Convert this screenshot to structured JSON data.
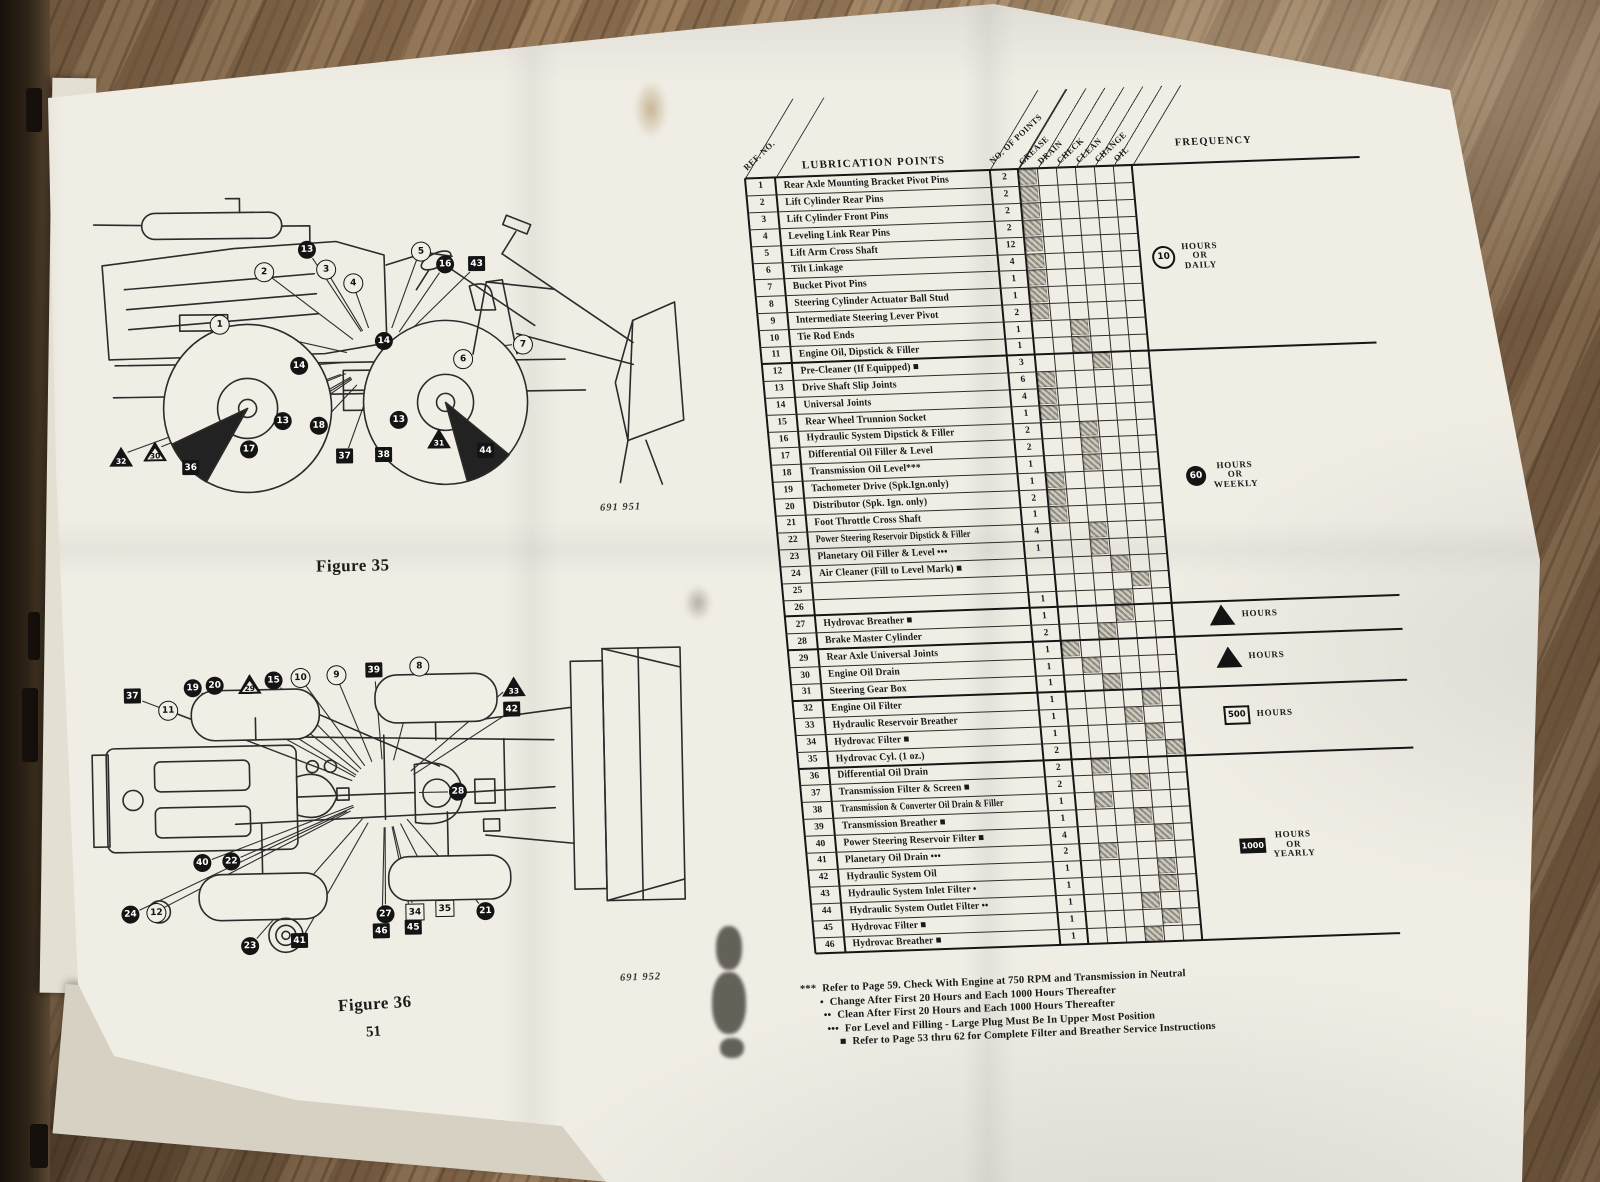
{
  "document": {
    "figure35": {
      "caption": "Figure 35",
      "photo_code": "691 951"
    },
    "figure36": {
      "caption": "Figure 36",
      "photo_code": "691 952"
    },
    "page_number": "51"
  },
  "table": {
    "title": "LUBRICATION POINTS",
    "ref_header": "REF. NO.",
    "points_header": "NO. OF POINTS",
    "frequency_header": "FREQUENCY",
    "operation_columns": [
      "GREASE",
      "DRAIN",
      "CHECK",
      "CLEAN",
      "CHANGE",
      "OIL"
    ],
    "rows": [
      {
        "ref": "1",
        "label": "Rear Axle Mounting Bracket Pivot Pins",
        "points": "2",
        "marks": [
          "grease"
        ]
      },
      {
        "ref": "2",
        "label": "Lift Cylinder Rear Pins",
        "points": "2",
        "marks": [
          "grease"
        ]
      },
      {
        "ref": "3",
        "label": "Lift Cylinder Front Pins",
        "points": "2",
        "marks": [
          "grease"
        ]
      },
      {
        "ref": "4",
        "label": "Leveling Link Rear Pins",
        "points": "2",
        "marks": [
          "grease"
        ]
      },
      {
        "ref": "5",
        "label": "Lift Arm Cross Shaft",
        "points": "12",
        "marks": [
          "grease"
        ]
      },
      {
        "ref": "6",
        "label": "Tilt Linkage",
        "points": "4",
        "marks": [
          "grease"
        ]
      },
      {
        "ref": "7",
        "label": "Bucket Pivot Pins",
        "points": "1",
        "marks": [
          "grease"
        ]
      },
      {
        "ref": "8",
        "label": "Steering Cylinder Actuator Ball Stud",
        "points": "1",
        "marks": [
          "grease"
        ]
      },
      {
        "ref": "9",
        "label": "Intermediate Steering Lever Pivot",
        "points": "2",
        "marks": [
          "grease"
        ]
      },
      {
        "ref": "10",
        "label": "Tie Rod Ends",
        "points": "1",
        "marks": [
          "check"
        ]
      },
      {
        "ref": "11",
        "label": "Engine Oil, Dipstick & Filler",
        "points": "1",
        "marks": [
          "check"
        ]
      },
      {
        "ref": "12",
        "label": "Pre-Cleaner (If Equipped) ■",
        "points": "3",
        "marks": [
          "clean"
        ]
      },
      {
        "ref": "13",
        "label": "Drive Shaft Slip Joints",
        "points": "6",
        "marks": [
          "grease"
        ]
      },
      {
        "ref": "14",
        "label": "Universal Joints",
        "points": "4",
        "marks": [
          "grease"
        ]
      },
      {
        "ref": "15",
        "label": "Rear Wheel Trunnion Socket",
        "points": "1",
        "marks": [
          "grease"
        ]
      },
      {
        "ref": "16",
        "label": "Hydraulic System Dipstick & Filler",
        "points": "2",
        "marks": [
          "check"
        ]
      },
      {
        "ref": "17",
        "label": "Differential Oil Filler & Level",
        "points": "2",
        "marks": [
          "check"
        ]
      },
      {
        "ref": "18",
        "label": "Transmission Oil Level***",
        "points": "1",
        "marks": [
          "check"
        ]
      },
      {
        "ref": "19",
        "label": "Tachometer Drive (Spk.Ign.only)",
        "points": "1",
        "marks": [
          "grease"
        ]
      },
      {
        "ref": "20",
        "label": "Distributor (Spk. Ign. only)",
        "points": "2",
        "marks": [
          "grease"
        ]
      },
      {
        "ref": "21",
        "label": "Foot Throttle Cross Shaft",
        "points": "1",
        "marks": [
          "grease"
        ]
      },
      {
        "ref": "22",
        "label": "Power Steering Reservoir Dipstick & Filler",
        "points": "4",
        "marks": [
          "check"
        ]
      },
      {
        "ref": "23",
        "label": "Planetary Oil Filler & Level •••",
        "points": "1",
        "marks": [
          "check"
        ]
      },
      {
        "ref": "24",
        "label": "Air Cleaner (Fill to Level Mark) ■",
        "points": "",
        "marks": [
          "clean"
        ]
      },
      {
        "ref": "25",
        "label": "",
        "points": "",
        "marks": [
          "change"
        ]
      },
      {
        "ref": "26",
        "label": "",
        "points": "1",
        "marks": [
          "clean"
        ]
      },
      {
        "ref": "27",
        "label": "Hydrovac Breather ■",
        "points": "1",
        "marks": [
          "clean"
        ]
      },
      {
        "ref": "28",
        "label": "Brake Master Cylinder",
        "points": "2",
        "marks": [
          "check"
        ]
      },
      {
        "ref": "29",
        "label": "Rear Axle Universal Joints",
        "points": "1",
        "marks": [
          "grease"
        ]
      },
      {
        "ref": "30",
        "label": "Engine Oil Drain",
        "points": "1",
        "marks": [
          "drain"
        ]
      },
      {
        "ref": "31",
        "label": "Steering Gear Box",
        "points": "1",
        "marks": [
          "check"
        ]
      },
      {
        "ref": "32",
        "label": "Engine Oil Filter",
        "points": "1",
        "marks": [
          "change"
        ]
      },
      {
        "ref": "33",
        "label": "Hydraulic Reservoir Breather",
        "points": "1",
        "marks": [
          "clean"
        ]
      },
      {
        "ref": "34",
        "label": "Hydrovac Filter ■",
        "points": "1",
        "marks": [
          "change"
        ]
      },
      {
        "ref": "35",
        "label": "Hydrovac Cyl. (1 oz.)",
        "points": "2",
        "marks": [
          "oil"
        ]
      },
      {
        "ref": "36",
        "label": "Differential Oil Drain",
        "points": "2",
        "marks": [
          "drain"
        ]
      },
      {
        "ref": "37",
        "label": "Transmission Filter & Screen ■",
        "points": "2",
        "marks": [
          "clean"
        ]
      },
      {
        "ref": "38",
        "label": "Transmission & Converter Oil Drain & Filler",
        "points": "1",
        "marks": [
          "drain"
        ]
      },
      {
        "ref": "39",
        "label": "Transmission Breather ■",
        "points": "1",
        "marks": [
          "clean"
        ]
      },
      {
        "ref": "40",
        "label": "Power Steering Reservoir Filter ■",
        "points": "4",
        "marks": [
          "change"
        ]
      },
      {
        "ref": "41",
        "label": "Planetary Oil Drain •••",
        "points": "2",
        "marks": [
          "drain"
        ]
      },
      {
        "ref": "42",
        "label": "Hydraulic System Oil",
        "points": "1",
        "marks": [
          "change"
        ]
      },
      {
        "ref": "43",
        "label": "Hydraulic System Inlet Filter •",
        "points": "1",
        "marks": [
          "change"
        ]
      },
      {
        "ref": "44",
        "label": "Hydraulic System Outlet Filter ••",
        "points": "1",
        "marks": [
          "clean"
        ]
      },
      {
        "ref": "45",
        "label": "Hydrovac Filter ■",
        "points": "1",
        "marks": [
          "change"
        ]
      },
      {
        "ref": "46",
        "label": "Hydrovac Breather ■",
        "points": "1",
        "marks": [
          "clean"
        ]
      }
    ],
    "frequency_sections": [
      {
        "from": 1,
        "to": 11,
        "symbol": "circle-outline",
        "value": "10",
        "label": "HOURS\nOR\nDAILY"
      },
      {
        "from": 12,
        "to": 26,
        "symbol": "circle-filled",
        "value": "60",
        "label": "HOURS\nOR\nWEEKLY"
      },
      {
        "from": 27,
        "to": 28,
        "symbol": "triangle-outline",
        "value": "120",
        "label": "HOURS"
      },
      {
        "from": 29,
        "to": 31,
        "symbol": "triangle-filled",
        "value": "240",
        "label": "HOURS"
      },
      {
        "from": 32,
        "to": 35,
        "symbol": "square-outline",
        "value": "500",
        "label": "HOURS"
      },
      {
        "from": 36,
        "to": 46,
        "symbol": "square-filled",
        "value": "1000",
        "label": "HOURS\nOR\nYEARLY"
      }
    ],
    "footnotes": [
      {
        "symbol": "***",
        "text": "Refer to Page 59. Check With Engine at 750 RPM and Transmission in Neutral"
      },
      {
        "symbol": "•",
        "text": "Change After First 20 Hours and Each 1000 Hours Thereafter"
      },
      {
        "symbol": "••",
        "text": "Clean After First 20 Hours and Each 1000 Hours Thereafter"
      },
      {
        "symbol": "•••",
        "text": "For Level and Filling - Large Plug Must Be In Upper Most Position"
      },
      {
        "symbol": "■",
        "text": "Refer to Page  53 thru 62 for Complete Filter and Breather Service Instructions"
      }
    ]
  },
  "figure35_callouts": [
    {
      "n": "13",
      "shape": "circle-filled",
      "x": 223,
      "y": 54
    },
    {
      "n": "2",
      "shape": "circle-outline",
      "x": 179,
      "y": 75
    },
    {
      "n": "3",
      "shape": "circle-outline",
      "x": 241,
      "y": 73
    },
    {
      "n": "4",
      "shape": "circle-outline",
      "x": 268,
      "y": 87
    },
    {
      "n": "5",
      "shape": "circle-outline",
      "x": 336,
      "y": 56
    },
    {
      "n": "16",
      "shape": "circle-filled",
      "x": 361,
      "y": 70
    },
    {
      "n": "43",
      "shape": "square-filled",
      "x": 393,
      "y": 71
    },
    {
      "n": "1",
      "shape": "circle-outline",
      "x": 134,
      "y": 127
    },
    {
      "n": "14",
      "shape": "circle-filled",
      "x": 299,
      "y": 146
    },
    {
      "n": "14",
      "shape": "circle-filled",
      "x": 214,
      "y": 170
    },
    {
      "n": "6",
      "shape": "circle-outline",
      "x": 377,
      "y": 164
    },
    {
      "n": "7",
      "shape": "circle-outline",
      "x": 437,
      "y": 150
    },
    {
      "n": "13",
      "shape": "circle-filled",
      "x": 197,
      "y": 225
    },
    {
      "n": "18",
      "shape": "circle-filled",
      "x": 233,
      "y": 230
    },
    {
      "n": "13",
      "shape": "circle-filled",
      "x": 313,
      "y": 225
    },
    {
      "n": "17",
      "shape": "circle-filled",
      "x": 163,
      "y": 253
    },
    {
      "n": "31",
      "shape": "triangle-filled",
      "x": 350,
      "y": 243
    },
    {
      "n": "32",
      "shape": "triangle-filled",
      "x": 32,
      "y": 258
    },
    {
      "n": "30",
      "shape": "triangle-outline",
      "x": 66,
      "y": 253
    },
    {
      "n": "36",
      "shape": "square-filled",
      "x": 105,
      "y": 272
    },
    {
      "n": "37",
      "shape": "square-filled",
      "x": 259,
      "y": 262
    },
    {
      "n": "38",
      "shape": "square-filled",
      "x": 298,
      "y": 261
    },
    {
      "n": "44",
      "shape": "square-filled",
      "x": 400,
      "y": 258
    }
  ],
  "figure36_callouts": [
    {
      "n": "37",
      "shape": "square-filled",
      "x": 50,
      "y": 67
    },
    {
      "n": "11",
      "shape": "circle-outline",
      "x": 84,
      "y": 80
    },
    {
      "n": "19",
      "shape": "circle-filled",
      "x": 110,
      "y": 59
    },
    {
      "n": "20",
      "shape": "circle-filled",
      "x": 132,
      "y": 57
    },
    {
      "n": "29",
      "shape": "triangle-outline",
      "x": 164,
      "y": 55
    },
    {
      "n": "15",
      "shape": "circle-filled",
      "x": 191,
      "y": 53
    },
    {
      "n": "10",
      "shape": "circle-outline",
      "x": 217,
      "y": 50
    },
    {
      "n": "9",
      "shape": "circle-outline",
      "x": 253,
      "y": 48
    },
    {
      "n": "39",
      "shape": "square-filled",
      "x": 292,
      "y": 46
    },
    {
      "n": "8",
      "shape": "circle-outline",
      "x": 336,
      "y": 41
    },
    {
      "n": "33",
      "shape": "triangle-filled",
      "x": 428,
      "y": 63
    },
    {
      "n": "42",
      "shape": "square-filled",
      "x": 429,
      "y": 88
    },
    {
      "n": "28",
      "shape": "circle-filled",
      "x": 373,
      "y": 168
    },
    {
      "n": "40",
      "shape": "circle-filled",
      "x": 116,
      "y": 234
    },
    {
      "n": "22",
      "shape": "circle-filled",
      "x": 145,
      "y": 233
    },
    {
      "n": "24",
      "shape": "circle-filled",
      "x": 43,
      "y": 284
    },
    {
      "n": "12",
      "shape": "circle-outline",
      "x": 68,
      "y": 282
    },
    {
      "n": "27",
      "shape": "circle-filled",
      "x": 298,
      "y": 289
    },
    {
      "n": "34",
      "shape": "square-outline",
      "x": 327,
      "y": 288
    },
    {
      "n": "35",
      "shape": "square-outline",
      "x": 357,
      "y": 285
    },
    {
      "n": "21",
      "shape": "circle-filled",
      "x": 398,
      "y": 288
    },
    {
      "n": "46",
      "shape": "square-filled",
      "x": 294,
      "y": 307
    },
    {
      "n": "45",
      "shape": "square-filled",
      "x": 326,
      "y": 304
    },
    {
      "n": "23",
      "shape": "circle-filled",
      "x": 162,
      "y": 318
    },
    {
      "n": "41",
      "shape": "square-filled",
      "x": 212,
      "y": 315
    }
  ],
  "colors": {
    "paper": "#f0ede5",
    "ink": "#1a1a1a",
    "wood": "#7a6148",
    "hatch": "#8f8b80"
  }
}
